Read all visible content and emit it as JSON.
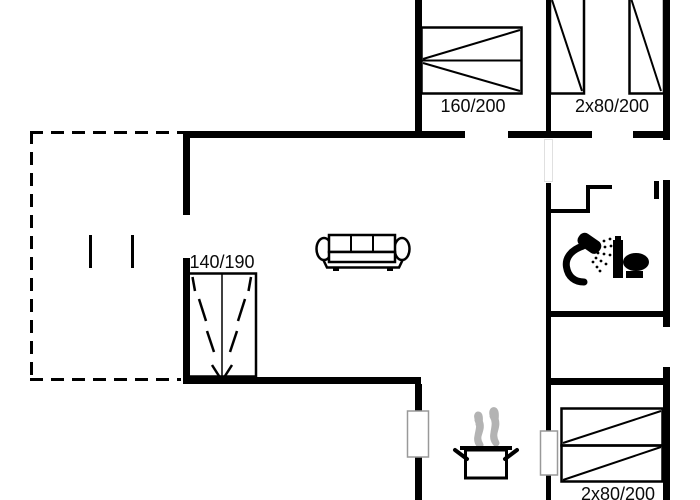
{
  "plan": {
    "type": "holiday-house-floor-plan",
    "colors": {
      "wall": "#000000",
      "background": "#ffffff",
      "steam": "#b3b3b3",
      "window_outline": "#999999"
    },
    "labels": {
      "bed_double_top": "160/200",
      "beds_twin_top": "2x80/200",
      "bed_double_left": "140/190",
      "beds_twin_bottom": "2x80/200"
    },
    "icons": {
      "sofa": "sofa-icon",
      "double_bed_top": "double-bed-icon",
      "twin_beds_top": "twin-beds-icon",
      "double_bed_left": "double-bed-icon",
      "bunk_beds_bottom": "twin-beds-icon",
      "cooking_pot": "cooking-pot-icon",
      "steam": "steam-icon",
      "shower": "shower-icon",
      "toilet": "toilet-icon"
    }
  }
}
